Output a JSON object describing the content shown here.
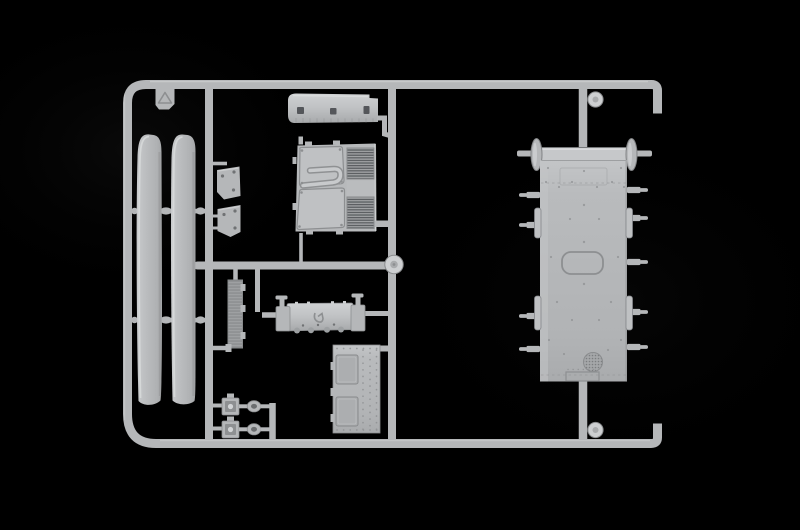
{
  "scene": {
    "title": "Plastic model kit sprue on black background",
    "description": "A single light-gray injection-molded polystyrene sprue (parts tree) from a truck scale-model kit, photographed against a pure black background. The rectangular runner frame holds trim strips, a slotted roof panel, a cab front with twin louvered grilles, a finned radiator strip, a ribbed tank with end brackets, a riveted equipment box, two small mirror/lamp assemblies with oval arms, and one large riveted deck panel with round end caps and many side gate pins.",
    "plastic_color_name": "light gray",
    "background_color_name": "black"
  },
  "palette": {
    "background": "#000000",
    "plastic": "#b5b7b9",
    "plastic_light": "#cdcfd1",
    "plastic_dark": "#8d8f91",
    "plastic_deep": "#707274",
    "recess": "#54565a",
    "highlight": "#dddfe0"
  },
  "parts": {
    "frame": "Outer sprue frame runner with hooked open ends",
    "runner_vertical_left": "Inner vertical runner, left",
    "runner_vertical_center": "Inner vertical runner, center",
    "runner_mid": "Horizontal mid runner",
    "runner_panel_top": "Runner stub to deck panel, top",
    "runner_panel_bottom": "Runner stub to deck panel, bottom",
    "runner_small_parts": "Short vertical runner for small parts",
    "tag": "Molded tab with recycling triangle symbol",
    "strip_front": "Long curved trim strip, front",
    "strip_rear": "Long curved trim strip, rear",
    "bracket_upper": "Small angled bracket, upper",
    "bracket_lower": "Small angled bracket, lower",
    "radiator": "Finned radiator core strip",
    "roof_panel": "Curved roof panel with three slots",
    "cab_front": "Cab front panel with windshield frames and twin louvered grilles",
    "tank": "Ribbed tank and step unit with end brackets",
    "battery_box": "Riveted equipment box with two recessed doors",
    "mirror_upper": "Small mirror or lamp body with oval arm, upper",
    "mirror_lower": "Small mirror or lamp body with oval arm, lower",
    "floor_panel": "Large riveted deck panel with round end caps and side gate pins",
    "disc_center": "Round molding disc at center junction",
    "disc_top": "Round molding disc at top junction",
    "disc_bottom": "Round molding disc at bottom junction"
  }
}
